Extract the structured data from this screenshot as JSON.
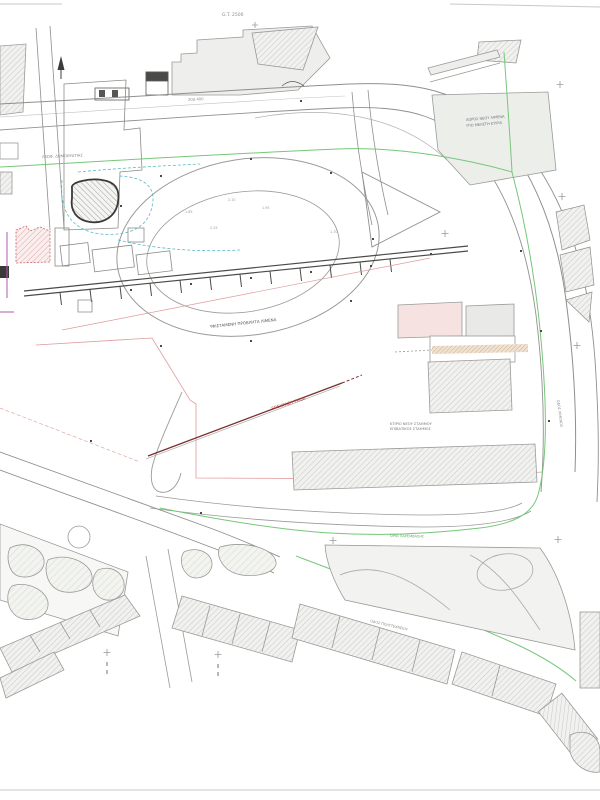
{
  "document": {
    "kind": "architectural site plan (CAD drawing)",
    "sheet_background": "#ffffff"
  },
  "labels": {
    "plot_ref": "G.T. 2500",
    "road_dim": "200.400",
    "street_top": "ΛΕΩΦ. ΔΗΜΟΚΡΑΤΙΑΣ",
    "area_note1": "ΧΩΡΟΣ ΝΕΟΥ ΛΙΜΕΝΑ",
    "area_note2": "ΥΠΟ ΜΕΛΕΤΗ ΚΤΙΡΙΑ",
    "tram_note": "ΕΠΕΚΤΑΣΗ ΤΡΑΜ",
    "station_note1": "ΚΤΙΡΙΟ ΝΕΟΥ ΣΤΑΘΜΟΥ",
    "station_note2": "ΕΠΙΒΑΤΙΚΟΣ ΣΤΑΘΜΟΣ",
    "pier_note": "ΥΦΙΣΤΑΜΕΝΗ ΠΡΟΒΛΗΤΑ ΛΙΜΕΝΑ",
    "boundary_note": "ΟΡΙΟ ΠΑΡΕΜΒΑΣΗΣ",
    "street_bottom": "ΟΔΟΣ ΠΟΛΥΤΕΧΝΕΙΟΥ",
    "street_right": "ΟΔΟΣ ΛΙΜΕΝΟΣ"
  },
  "spot_levels": [
    "1.85",
    "2.10",
    "1.95",
    "2.25",
    "1.70"
  ],
  "colors": {
    "line_gray": "#8a8a8a",
    "line_dark": "#4a4a4a",
    "boundary_green": "#76c77a",
    "utility_cyan": "#5ab8c0",
    "boundary_pink": "#e09a9a",
    "cadastre_magenta": "#b05ab0",
    "tram_maroon": "#7a3030",
    "note_red": "#b04a4a",
    "building_fill": "#efefed",
    "red_fill": "#f6e3e1"
  }
}
